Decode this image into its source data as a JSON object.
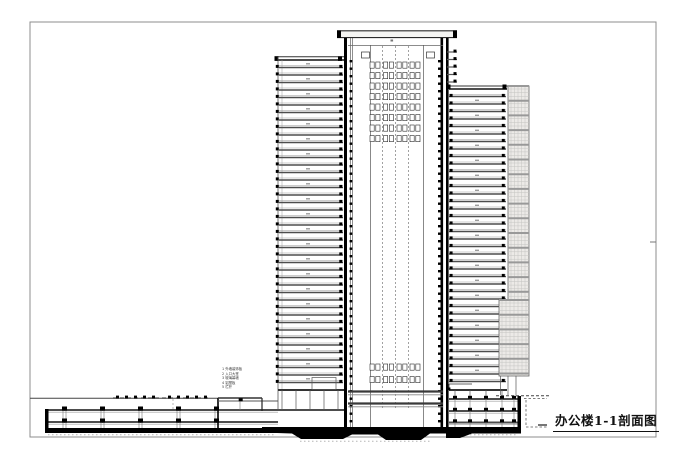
{
  "title_block": {
    "title": "办公楼1-1剖面图"
  },
  "legend": {
    "items": [
      "1  外墙装饰板",
      "2  入口大堂",
      "3  玻璃幕墙",
      "4  铝塑板",
      "5  栏杆"
    ]
  },
  "drawing": {
    "type": "architectural-section",
    "left_wing_floors": 43,
    "right_wing_floors": 39,
    "floor_pitch": 7.5,
    "upper_core_rows": 8,
    "lower_core_rows": 2,
    "core_pair_columns": [
      375,
      388.5,
      402,
      415
    ],
    "core_dash_lines": [
      382.5,
      395.5,
      408.5
    ],
    "podium_columns": [
      63,
      101,
      139,
      177,
      215
    ],
    "basement_columns": [
      455,
      470,
      486,
      502,
      514
    ],
    "colors": {
      "ink": "#1f1f1f",
      "slab": "#4d4d4d",
      "light": "#9c9c9c",
      "faint": "#c4c4c1",
      "hatch_bg": "#eceae7",
      "frame": "#8c8c8c",
      "paper": "#ffffff"
    }
  }
}
